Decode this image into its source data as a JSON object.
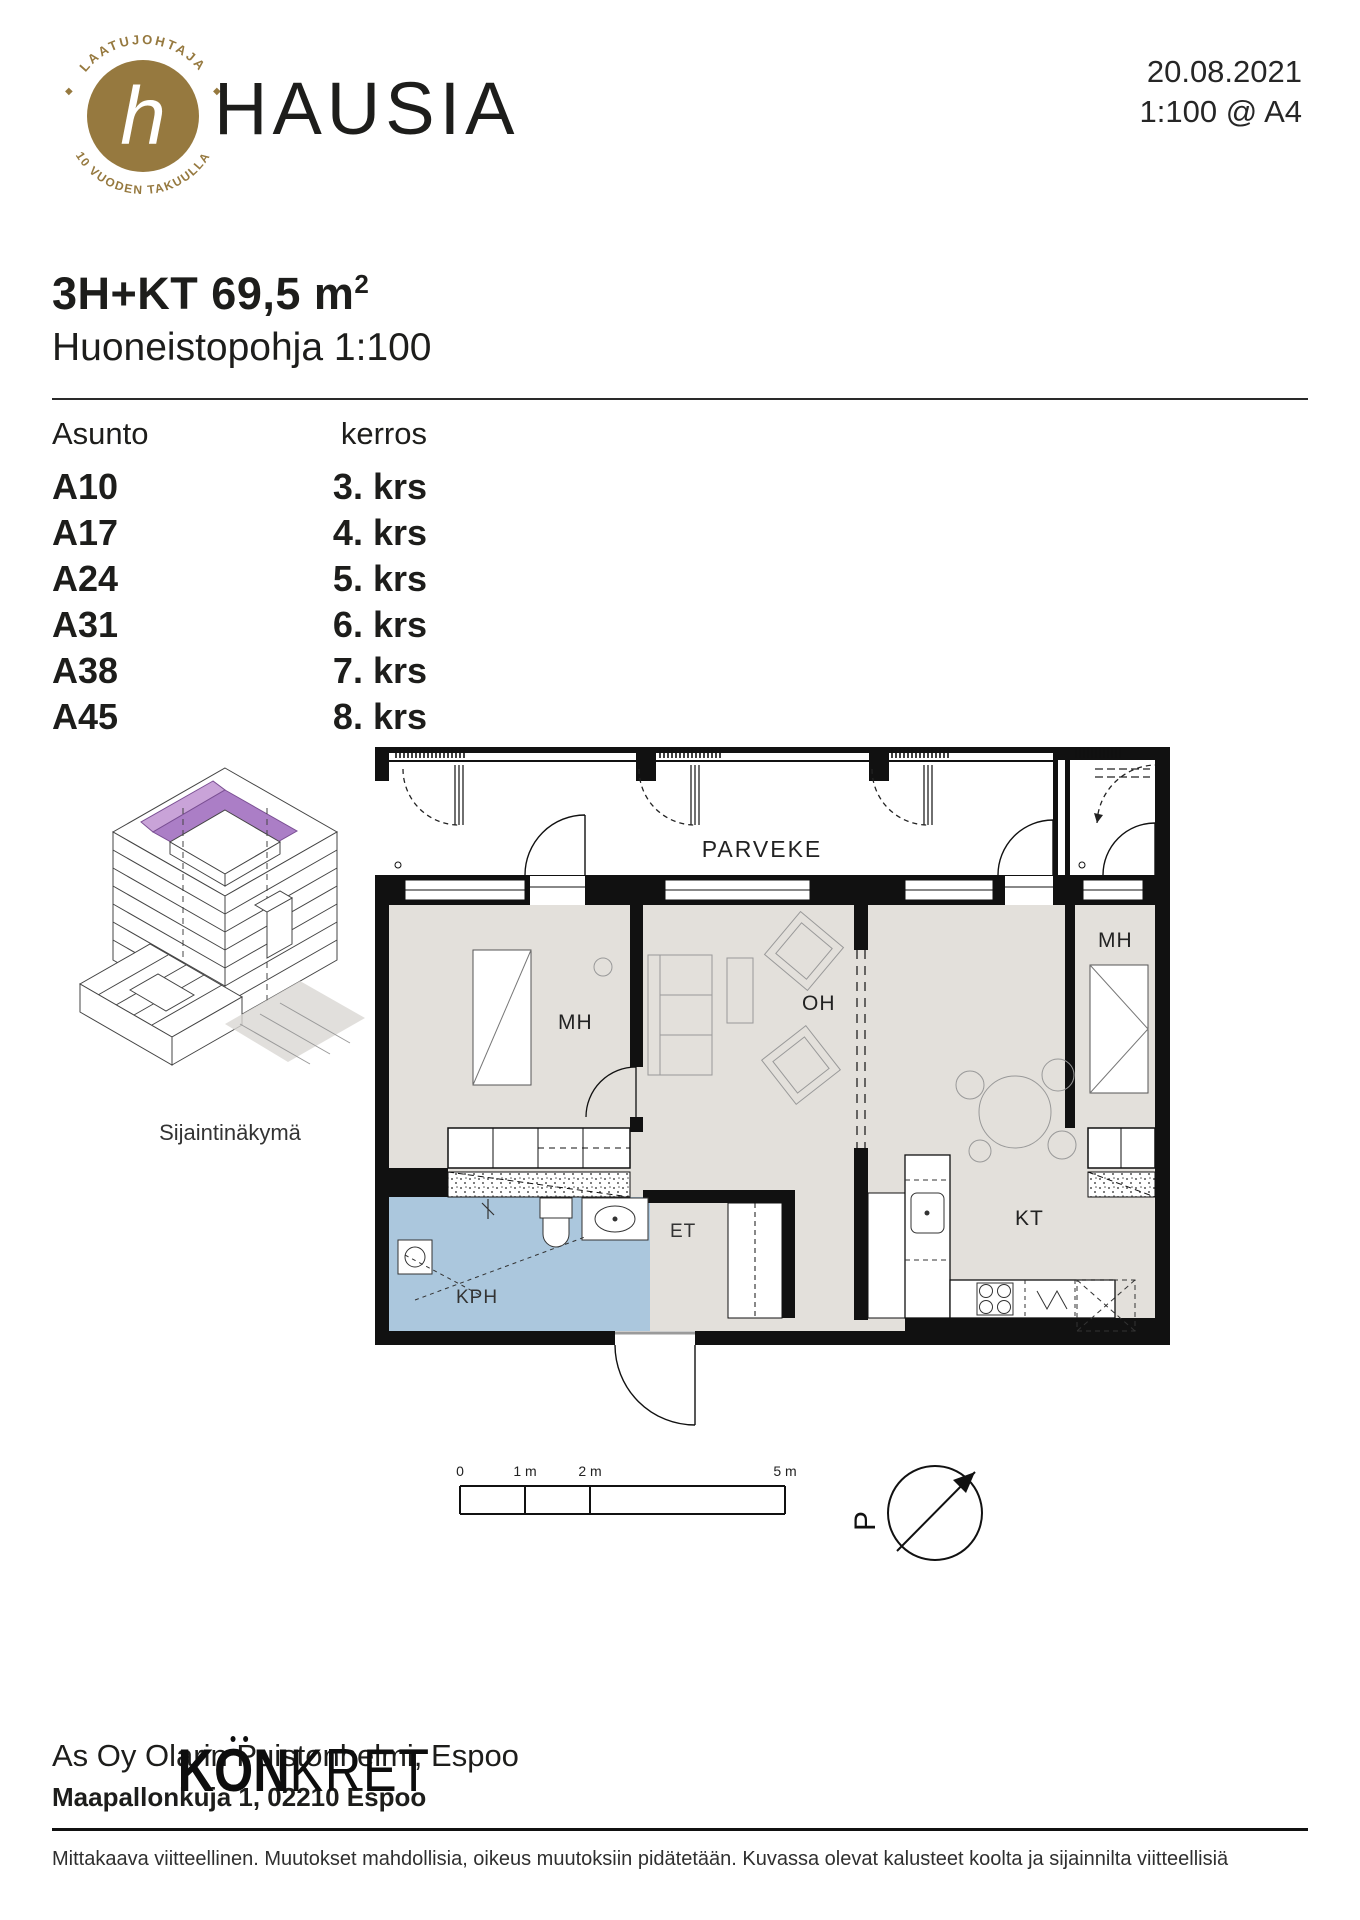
{
  "header": {
    "brand": "HAUSIA",
    "logo": {
      "top": "LAATUJOHTAJA",
      "bottom": "10 VUODEN TAKUULLA",
      "monogram": "h"
    },
    "date": "20.08.2021",
    "scale_note": "1:100 @ A4"
  },
  "title": {
    "area": "3H+KT 69,5 m",
    "area_sup": "2",
    "subtitle": "Huoneistopohja 1:100"
  },
  "units": {
    "col_apartment": "Asunto",
    "col_floor": "kerros",
    "rows": [
      {
        "unit": "A10",
        "floor": "3. krs"
      },
      {
        "unit": "A17",
        "floor": "4. krs"
      },
      {
        "unit": "A24",
        "floor": "5. krs"
      },
      {
        "unit": "A31",
        "floor": "6. krs"
      },
      {
        "unit": "A38",
        "floor": "7. krs"
      },
      {
        "unit": "A45",
        "floor": "8. krs"
      }
    ]
  },
  "location_view": {
    "caption": "Sijaintinäkymä",
    "highlight_color": "#ab7ec6"
  },
  "floor_plan": {
    "rooms": {
      "parveke": "PARVEKE",
      "mh_left": "MH",
      "mh_right": "MH",
      "oh": "OH",
      "kt": "KT",
      "kph": "KPH",
      "et": "ET"
    },
    "colors": {
      "floor": "#e3e0db",
      "bathroom": "#abc7dd",
      "wall": "#111111"
    }
  },
  "scale_bar": {
    "labels": [
      "0",
      "1 m",
      "2 m",
      "5 m"
    ]
  },
  "compass": {
    "label": "P"
  },
  "footer": {
    "project": "As Oy Olarin Puistonhelmi, Espoo",
    "address": "Maapallonkuja 1, 02210 Espoo",
    "brand_bold": "KON",
    "brand_light": "KRET",
    "disclaimer": "Mittakaava viitteellinen. Muutokset mahdollisia, oikeus muutoksiin pidätetään. Kuvassa olevat kalusteet koolta ja sijainnilta viitteellisiä"
  }
}
